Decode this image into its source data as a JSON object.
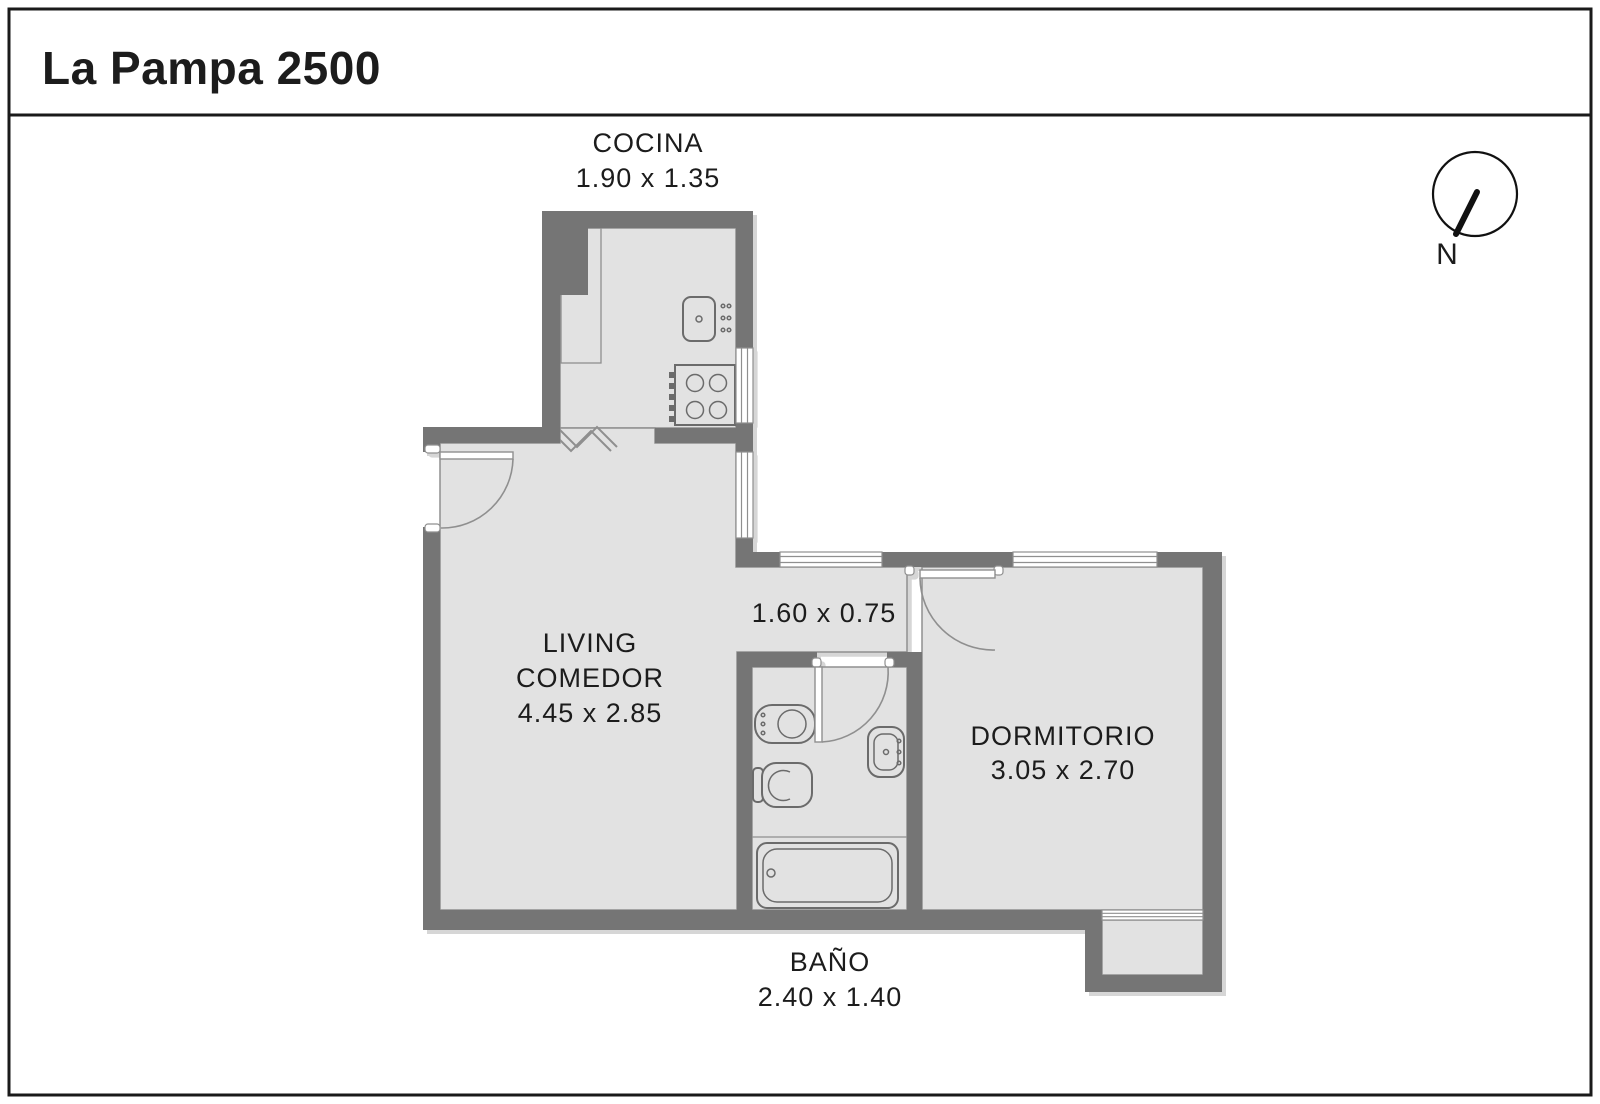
{
  "title": "La Pampa 2500",
  "compass": {
    "label": "N"
  },
  "rooms": {
    "cocina": {
      "name": "COCINA",
      "dims": "1.90 x 1.35"
    },
    "living": {
      "name_line1": "LIVING",
      "name_line2": "COMEDOR",
      "dims": "4.45 x 2.85"
    },
    "pasillo": {
      "dims": "1.60 x 0.75"
    },
    "dormitorio": {
      "name": "DORMITORIO",
      "dims": "3.05 x 2.70"
    },
    "bano": {
      "name": "BAÑO",
      "dims": "2.40 x 1.40"
    }
  },
  "colors": {
    "wall": "#757575",
    "floor": "#e2e2e2",
    "outline": "#8f8f8f",
    "fixture": "#6b6b6b",
    "text": "#1c1c1c"
  }
}
